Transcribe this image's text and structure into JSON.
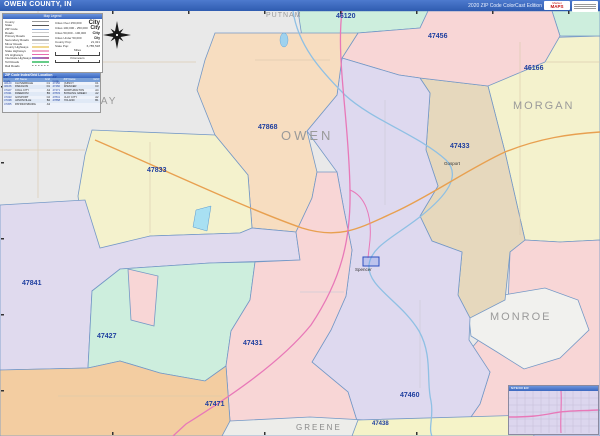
{
  "header": {
    "title": "OWEN COUNTY, IN",
    "edition": "2020 ZIP Code ColorCast Edition",
    "logo_prefix": "Market",
    "logo": "MAPS"
  },
  "legend": {
    "title": "Map Legend",
    "items": [
      "County",
      "State",
      "ZIP Code",
      "Roads",
      "Primary Roads",
      "Secondary Roads",
      "Minor Roads",
      "County Highways",
      "State Highways",
      "US Highways",
      "Interstate Highways",
      "Toll Roads",
      "Rail Roads"
    ],
    "city_rows": [
      {
        "label": "Cities Over 250,000",
        "sample": "City"
      },
      {
        "label": "Cities 100,000 - 250,000",
        "sample": "City"
      },
      {
        "label": "Cities 50,000 - 100,000",
        "sample": "City"
      },
      {
        "label": "Cities Under 50,000",
        "sample": "City"
      }
    ],
    "stats": [
      {
        "label": "County Pop:",
        "value": "21,321"
      },
      {
        "label": "State Pop:",
        "value": "6,785,528"
      }
    ],
    "scale_miles": "Miles",
    "scale_km": "Kilometers"
  },
  "zip_index": {
    "title": "ZIP Code Index/Grid Location",
    "columns": [
      "ZIP Code",
      "ZIP Name",
      "Grid"
    ],
    "rows": [
      [
        "46120",
        "CLOVERDALE",
        "C1"
      ],
      [
        "46166",
        "PARAGON",
        "D1"
      ],
      [
        "47427",
        "COAL CITY",
        "A3"
      ],
      [
        "47431",
        "FREEDOM",
        "B3"
      ],
      [
        "47433",
        "GOSPORT",
        "C2"
      ],
      [
        "47438",
        "JASONVILLE",
        "B4"
      ],
      [
        "47455",
        "PATRICKSBURG",
        "A3"
      ],
      [
        "47456",
        "QUINCY",
        "C1"
      ],
      [
        "47460",
        "SPENCER",
        "C3"
      ],
      [
        "47471",
        "WORTHINGTON",
        "A4"
      ],
      [
        "47833",
        "BOWLING GREEN",
        "A2"
      ],
      [
        "47841",
        "CLAY CITY",
        "A2"
      ],
      [
        "47868",
        "POLAND",
        "B1"
      ]
    ]
  },
  "map": {
    "zip_labels": [
      "46120",
      "47456",
      "46166",
      "47433",
      "47868",
      "47833",
      "47841",
      "47427",
      "47431",
      "47460",
      "47471",
      "47438"
    ],
    "county_labels": [
      "PUTNAM",
      "CLAY",
      "OWEN",
      "MORGAN",
      "MONROE",
      "GREENE"
    ],
    "city_labels": [
      "Spencer",
      "Gosport"
    ],
    "inset_title": "SPENCER"
  },
  "colors": {
    "header_blue": "#3a67c0",
    "zip_label_blue": "#1f3f9f",
    "county_label_gray": "#9a9a9a",
    "region_46120": "#cdeedd",
    "region_47456": "#f8d6d6",
    "region_46166": "#f4f2cd",
    "region_47433": "#e6d8bd",
    "region_47868": "#f7ddc0",
    "region_47833": "#f4f2cd",
    "region_47841": "#e0daee",
    "region_47427": "#cdeedd",
    "region_47431": "#f8d6d6",
    "region_47460": "#ded9ef",
    "region_47471": "#f3cda1",
    "region_47438": "#f5f3c8",
    "water_blue": "#8fc0e4",
    "highway_orange": "#e8a050",
    "highway_pink": "#e878b8"
  }
}
